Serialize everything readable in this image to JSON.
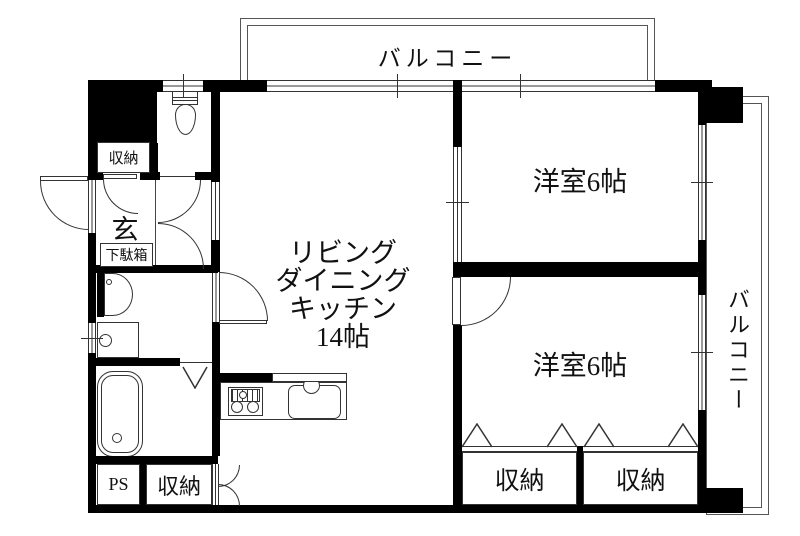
{
  "plan_labels": {
    "balcony_top": "バルコニー",
    "balcony_right": "バルコニー",
    "bedroom_top": "洋室6帖",
    "bedroom_bottom": "洋室6帖",
    "ldk": [
      "リビング",
      "ダイニング",
      "キッチン",
      "14帖"
    ],
    "entrance": "玄",
    "shoe_cabinet": "下駄箱",
    "hall_closet": "収納",
    "ldk_closet": "収納",
    "closet_left": "収納",
    "closet_right": "収納",
    "pipe_space": "PS"
  },
  "fixtures": {
    "toilet": "toilet-plan-icon",
    "washbasin": "washbasin-plan-icon",
    "washer_pan": "washing-machine-pan-icon",
    "bathtub": "bathtub-plan-icon",
    "stove": "gas-stove-icon",
    "sink": "kitchen-sink-icon"
  },
  "colors": {
    "wall": "#000000",
    "thin_line": "#333333",
    "background": "#ffffff",
    "text": "#111111"
  }
}
